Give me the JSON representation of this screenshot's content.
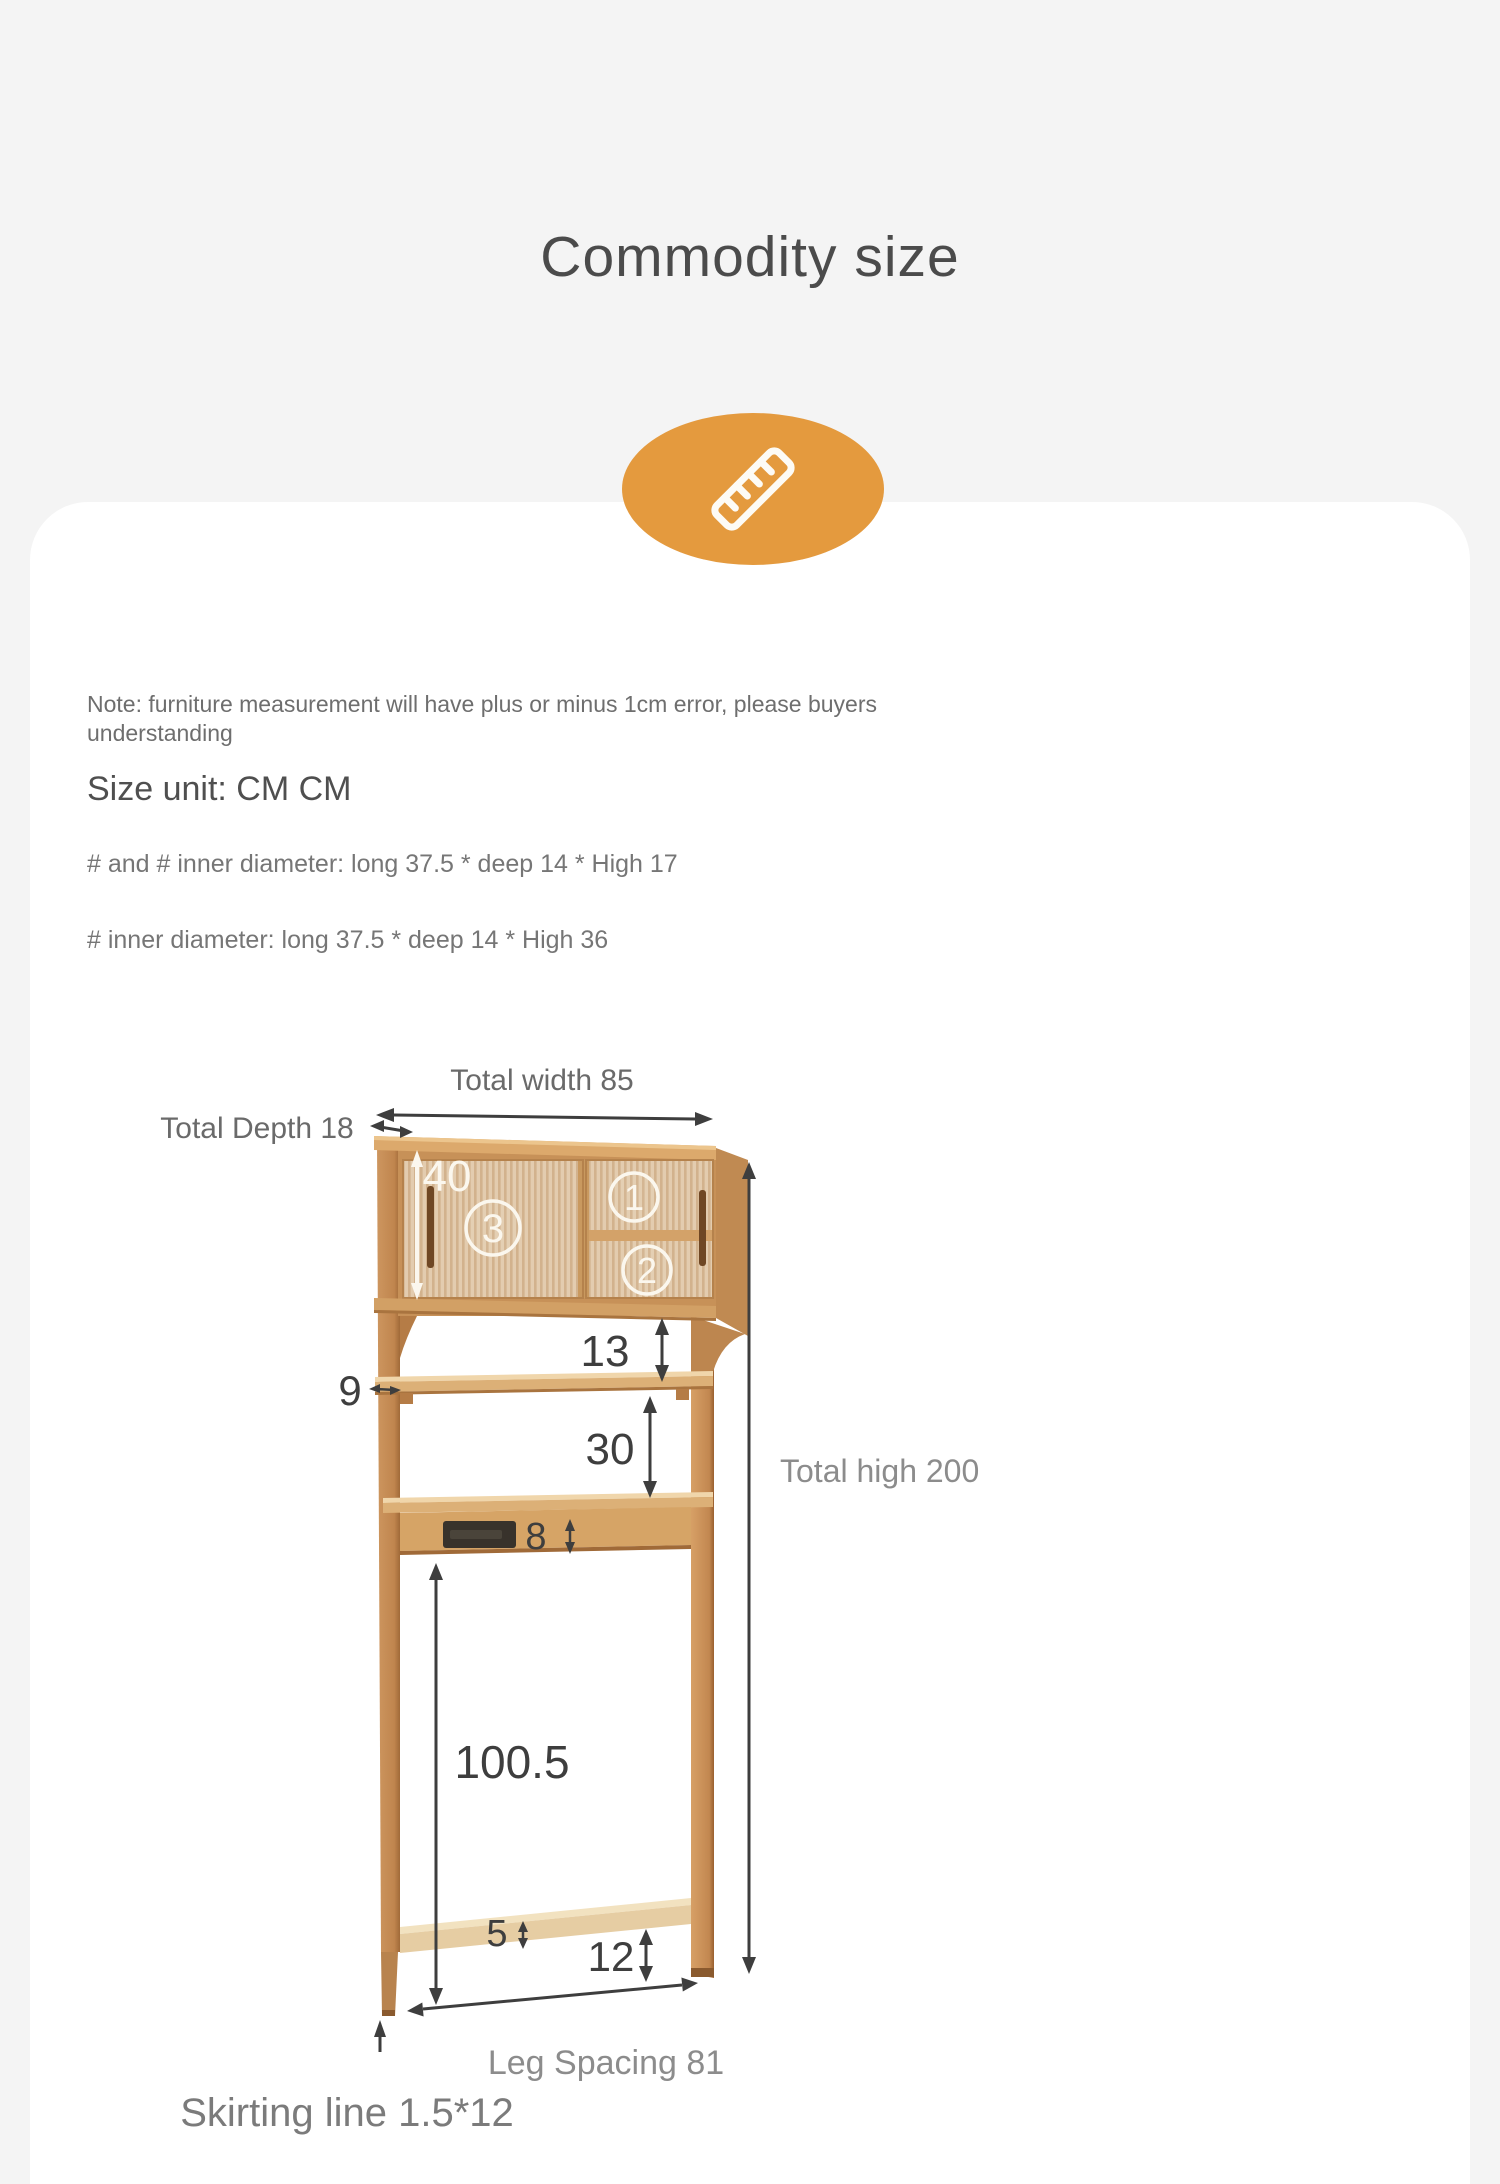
{
  "page": {
    "title": "Commodity size",
    "background": "#f4f4f4",
    "card_color": "#ffffff",
    "accent_orange": "#e49a3e",
    "wood_color": "#c9935c",
    "arrow_color": "#3e3e3e"
  },
  "badge": {
    "icon": "ruler-icon"
  },
  "notes": {
    "line1": "Note: furniture measurement will have plus or minus 1cm error, please buyers",
    "line2": "understanding"
  },
  "size_unit": "Size unit: CM CM",
  "specs": [
    "# and # inner diameter: long 37.5 * deep 14 * High 17",
    "# inner diameter: long 37.5 * deep 14 * High 36"
  ],
  "diagram": {
    "total_width": "Total width 85",
    "total_depth": "Total Depth 18",
    "total_high": "Total high 200",
    "leg_spacing": "Leg Spacing 81",
    "skirting_line": "Skirting line 1.5*12",
    "cabinet_height": "40",
    "gap_cabinet_shelf": "13",
    "shelf_thickness": "9",
    "gap_shelves": "30",
    "rail_height": "8",
    "leg_clearance": "100.5",
    "skirting_height": "5",
    "foot_height": "12",
    "compartment_1": "1",
    "compartment_2": "2",
    "compartment_3": "3"
  }
}
